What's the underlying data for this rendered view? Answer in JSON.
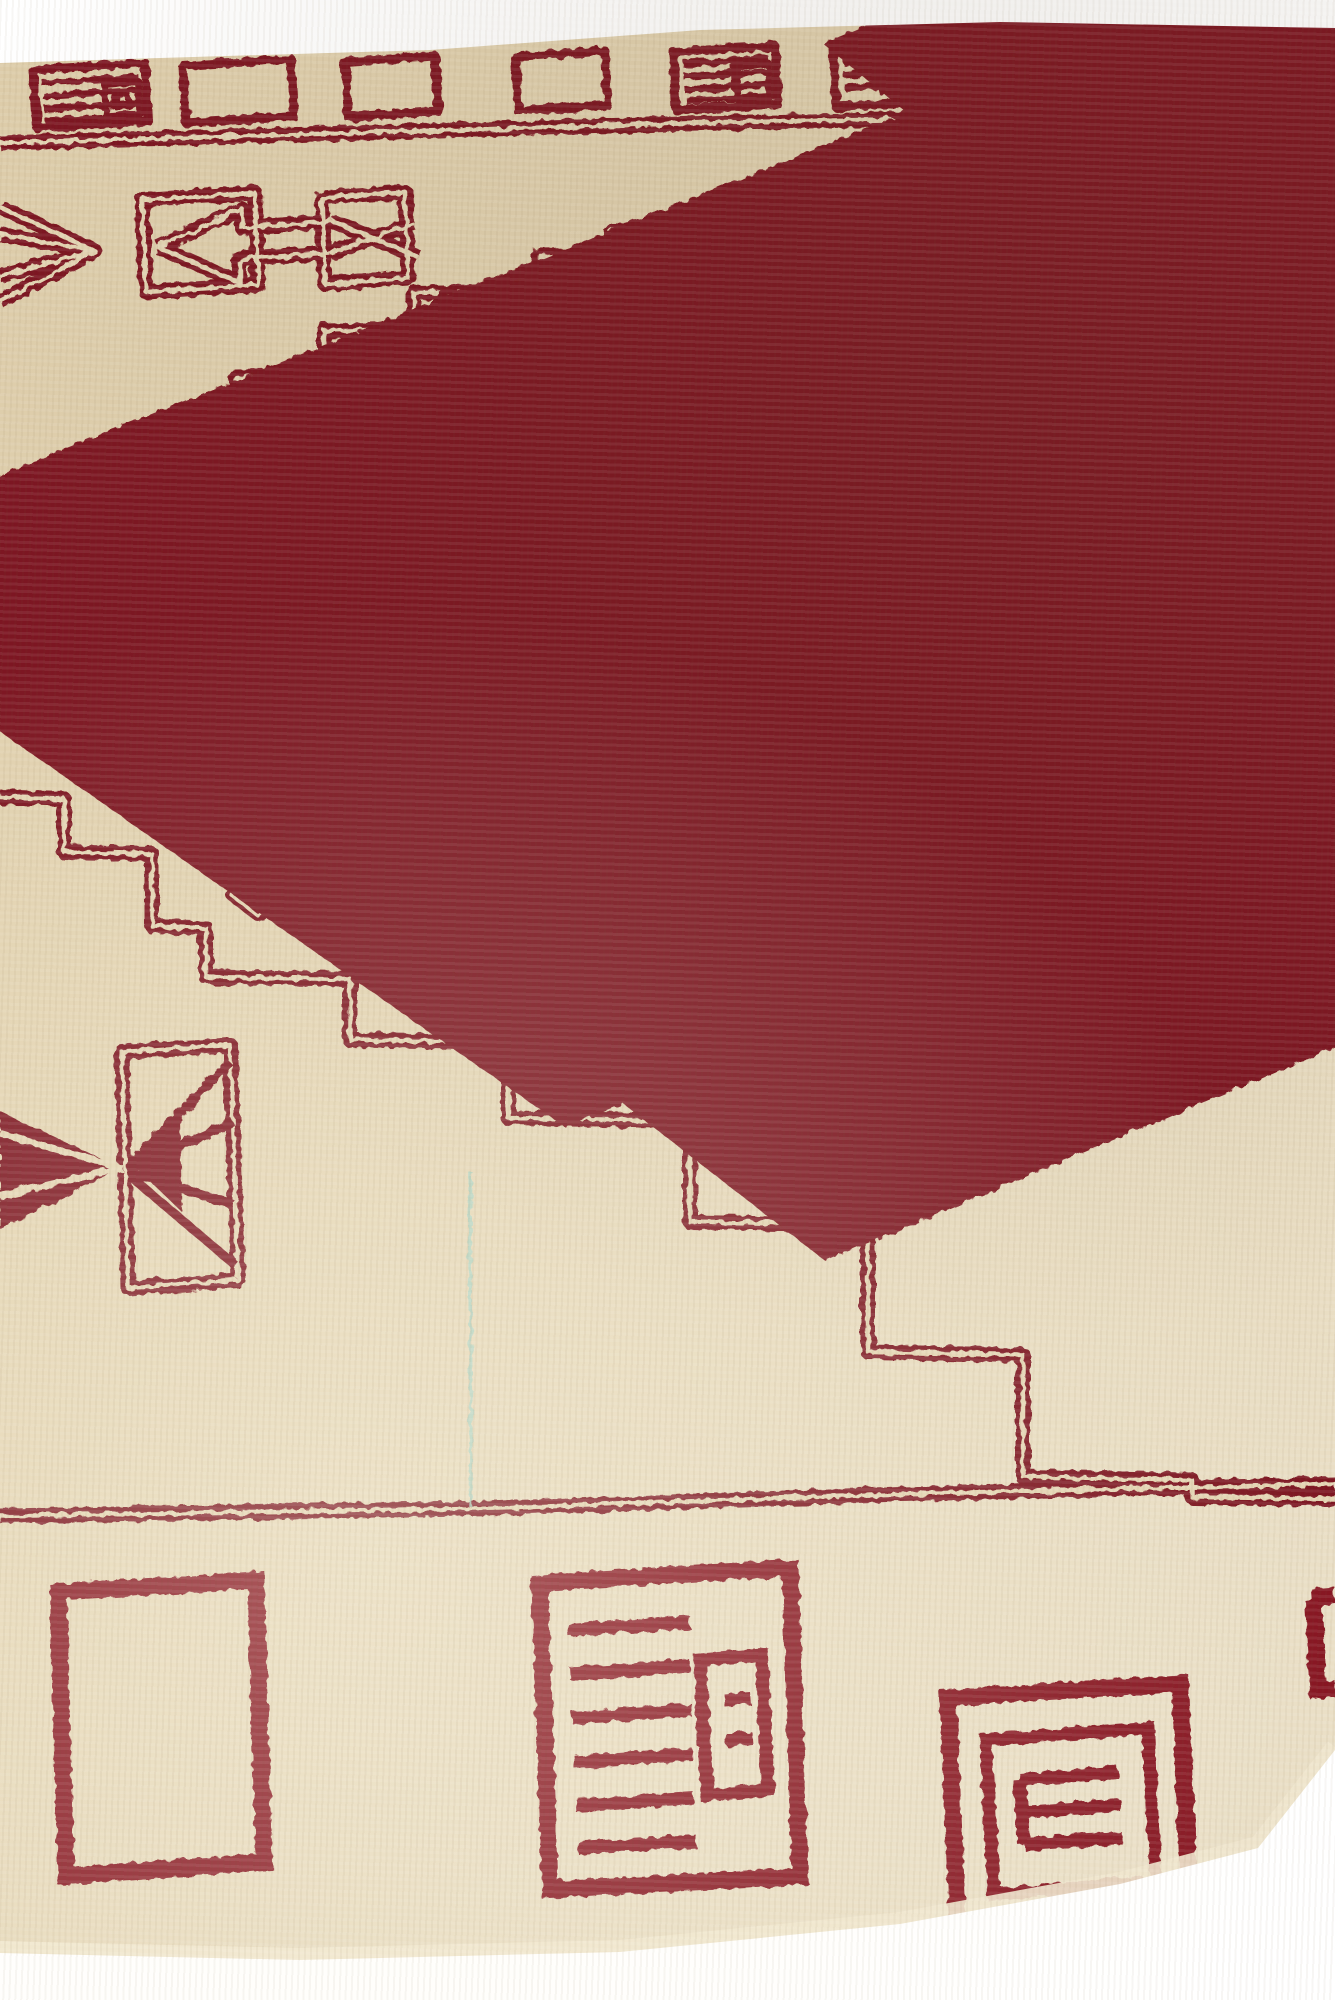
{
  "figure": {
    "type": "photograph",
    "subject": "Hand-knotted beige Moroccan berber-style wool rug with dark red geometric tribal motifs, photographed at a perspective angle on a white background",
    "background": "white seamless"
  },
  "palette": {
    "paper": "#ffffff",
    "base": "#e4d5b4",
    "baseDark": "#d8c7a4",
    "baseLight": "#ecdfc4",
    "motif": "#7d1620",
    "motifDeep": "#871322",
    "accent": "#aed2c2",
    "pile": "#efe5cd"
  },
  "motif_inventory": {
    "top_row": {
      "spiral_meander_squares": 4,
      "plain_outline_squares": 4,
      "crossed_x_motifs": 1
    },
    "horizontal_double_border_lines": 3,
    "arrow_bowtie_motifs_row2": 2,
    "stepped_arch_medallion": 1,
    "standing_loop_hooks_upper_row": 8,
    "hanging_loop_hooks_lower_row": 4,
    "branch_diamonds_column": 8,
    "central_lozenge_medallion": {
      "outer_double_outline": 1,
      "inner_grid_diamonds_3x3": 4,
      "partial_grid_diamonds_at_edges": 2
    },
    "grand_staircase_steps": 12,
    "left_arrow_square_motif": 1,
    "bottom_row": {
      "plain_thick_square": 1,
      "spiral_meander_squares": 2,
      "partial_edge_square": 1
    },
    "pale_teal_weft_line": 1
  }
}
